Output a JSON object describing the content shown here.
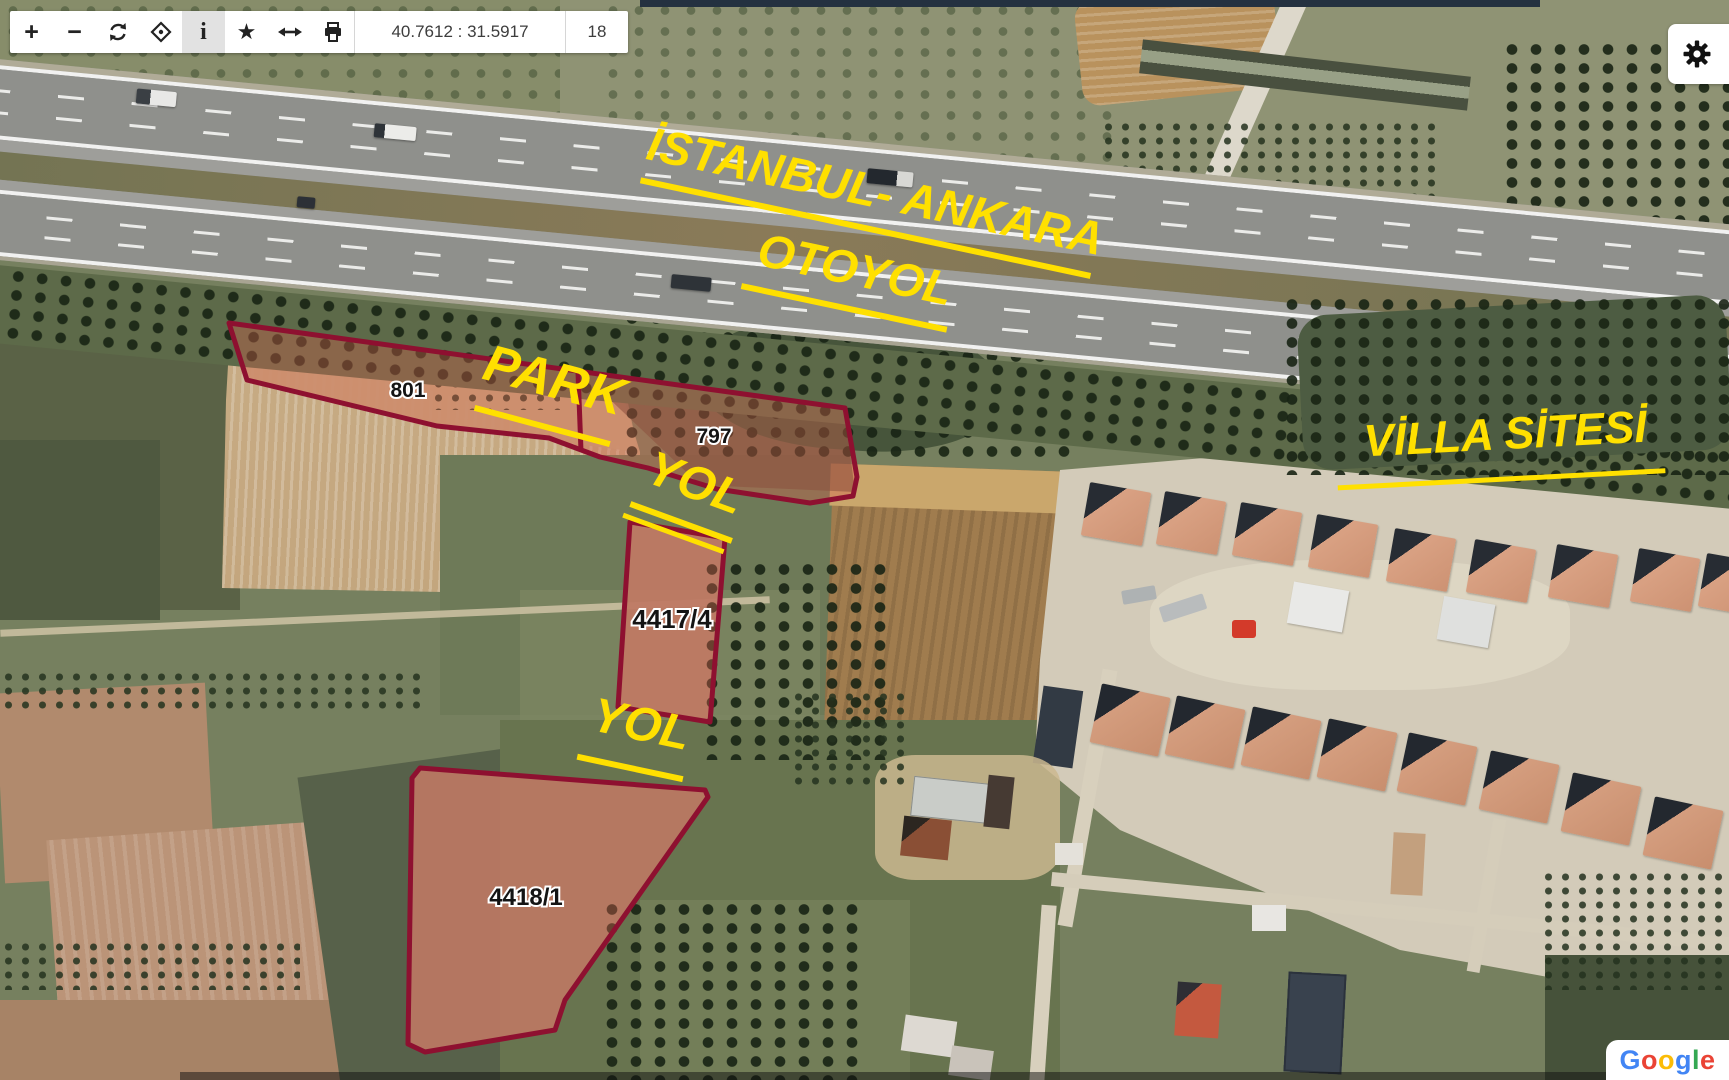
{
  "toolbar": {
    "buttons": [
      {
        "name": "zoom-in",
        "glyph": "+"
      },
      {
        "name": "zoom-out",
        "glyph": "−"
      },
      {
        "name": "refresh"
      },
      {
        "name": "center-map"
      },
      {
        "name": "info",
        "glyph": "i",
        "active": true
      },
      {
        "name": "favorites",
        "glyph": "★"
      },
      {
        "name": "extent-arrows"
      },
      {
        "name": "print"
      }
    ],
    "coordinates": "40.7612 : 31.5917",
    "zoom_level": "18"
  },
  "map_labels": {
    "highway_line1": "İSTANBUL- ANKARA",
    "highway_line2": "OTOYOL",
    "park": "PARK",
    "yol_upper": "YOL",
    "yol_lower": "YOL",
    "villa_site": "VİLLA SİTESİ"
  },
  "parcels": [
    {
      "id": "801"
    },
    {
      "id": "797"
    },
    {
      "id": "4417/4"
    },
    {
      "id": "4418/1"
    }
  ],
  "attribution": {
    "text": "Google",
    "letters": [
      {
        "ch": "G",
        "color": "#4285F4"
      },
      {
        "ch": "o",
        "color": "#EA4335"
      },
      {
        "ch": "o",
        "color": "#FBBC05"
      },
      {
        "ch": "g",
        "color": "#4285F4"
      },
      {
        "ch": "l",
        "color": "#34A853"
      },
      {
        "ch": "e",
        "color": "#EA4335"
      }
    ]
  },
  "colors": {
    "parcel_outline": "#8e1030",
    "parcel_fill": "rgba(214,96,77,0.38)",
    "label_yellow": "#ffe000"
  }
}
